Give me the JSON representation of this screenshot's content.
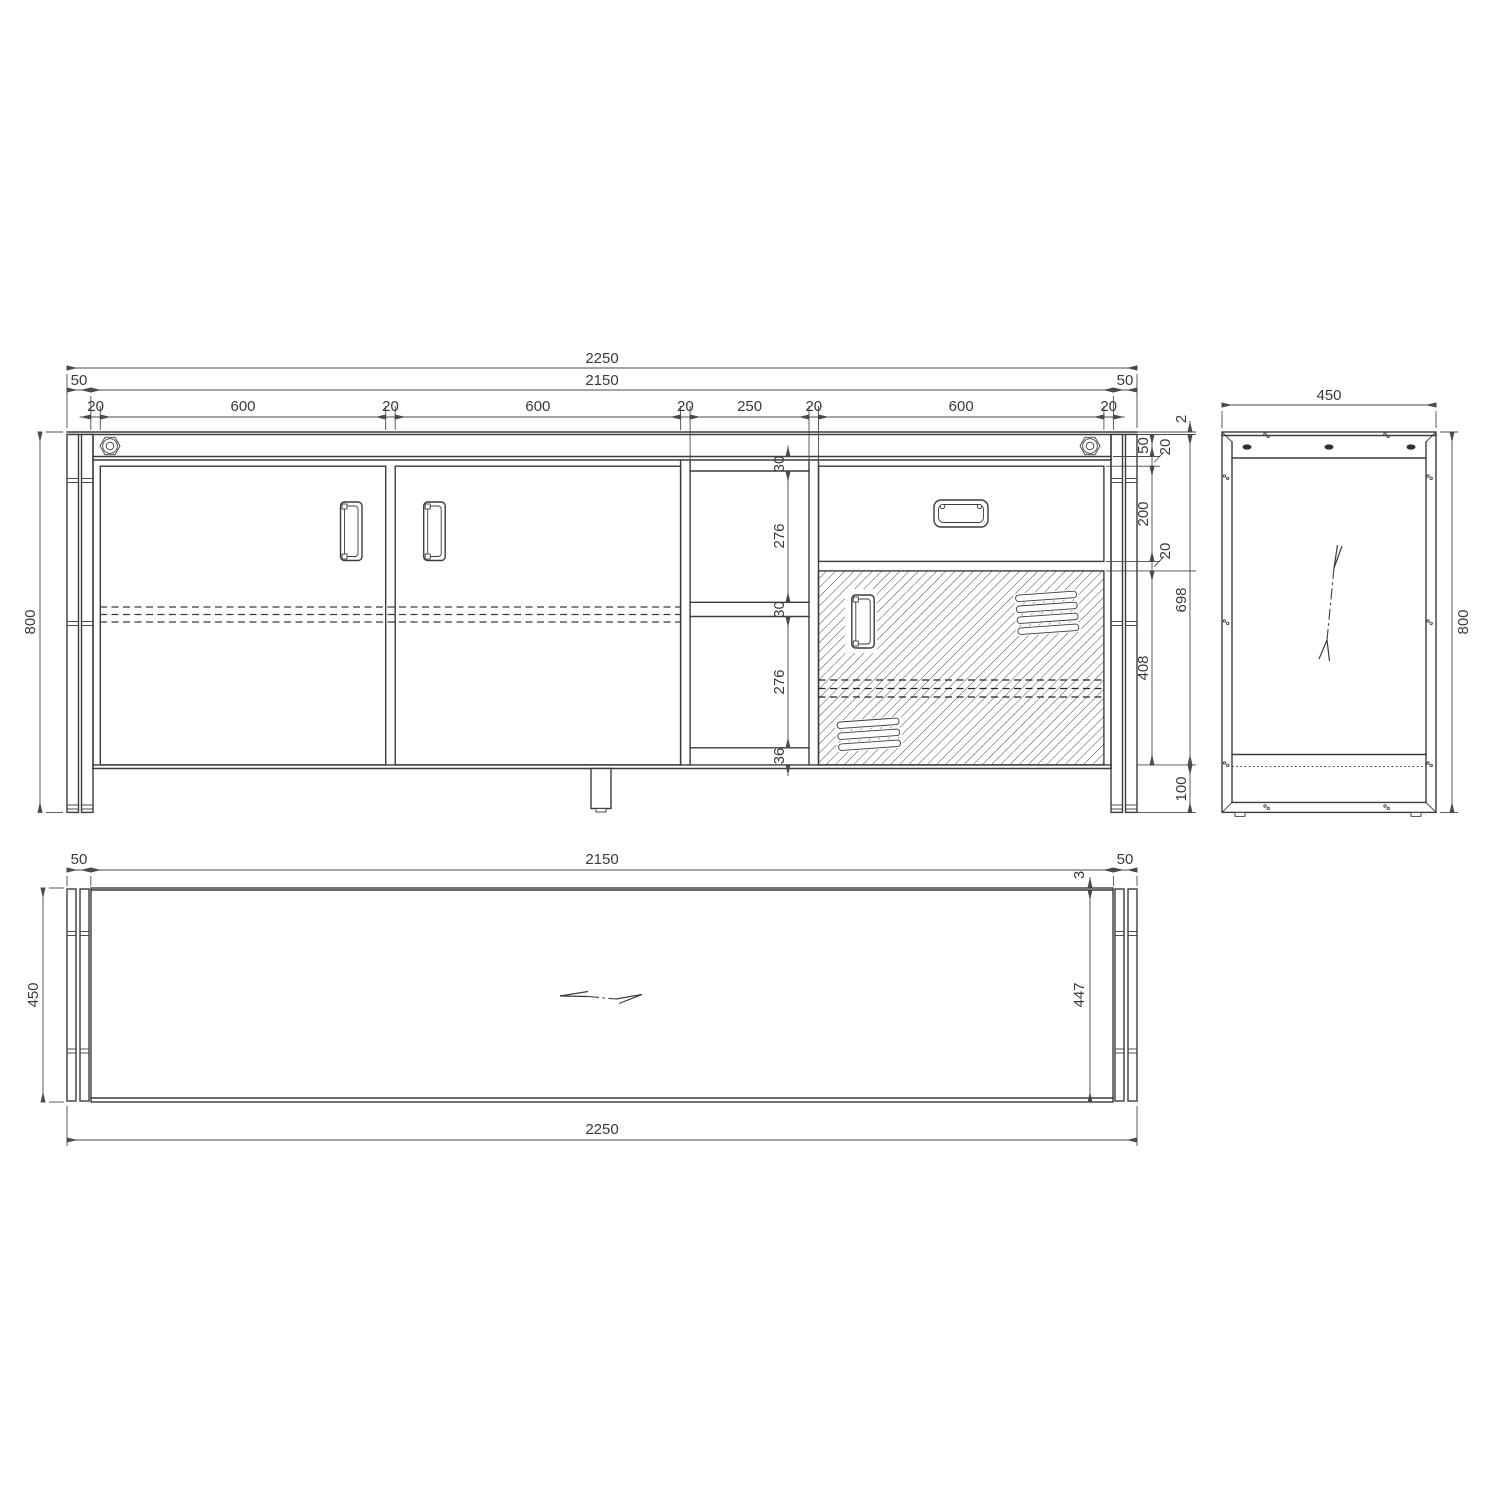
{
  "colors": {
    "background": "#ffffff",
    "line": "#3c3c3c",
    "dim": "#4a4a4a",
    "hatch": "#4a4a4a"
  },
  "views": {
    "front": {
      "dims": {
        "total_width": "2250",
        "row2": [
          "50",
          "2150",
          "50"
        ],
        "row3": [
          "20",
          "600",
          "20",
          "600",
          "20",
          "250",
          "20",
          "600",
          "20"
        ],
        "height": "800",
        "center_col": [
          "30",
          "276",
          "30",
          "276",
          "36"
        ],
        "right_col_a": [
          "50",
          "20",
          "200",
          "20",
          "408"
        ],
        "right_col_b": [
          "2",
          "698",
          "100"
        ]
      }
    },
    "side": {
      "dims": {
        "width": "450",
        "height": "800"
      }
    },
    "plan": {
      "dims": {
        "row_top": [
          "50",
          "2150",
          "50"
        ],
        "front_overhang": "3",
        "depth": "450",
        "depth_inner": "447",
        "total_width": "2250"
      }
    }
  }
}
